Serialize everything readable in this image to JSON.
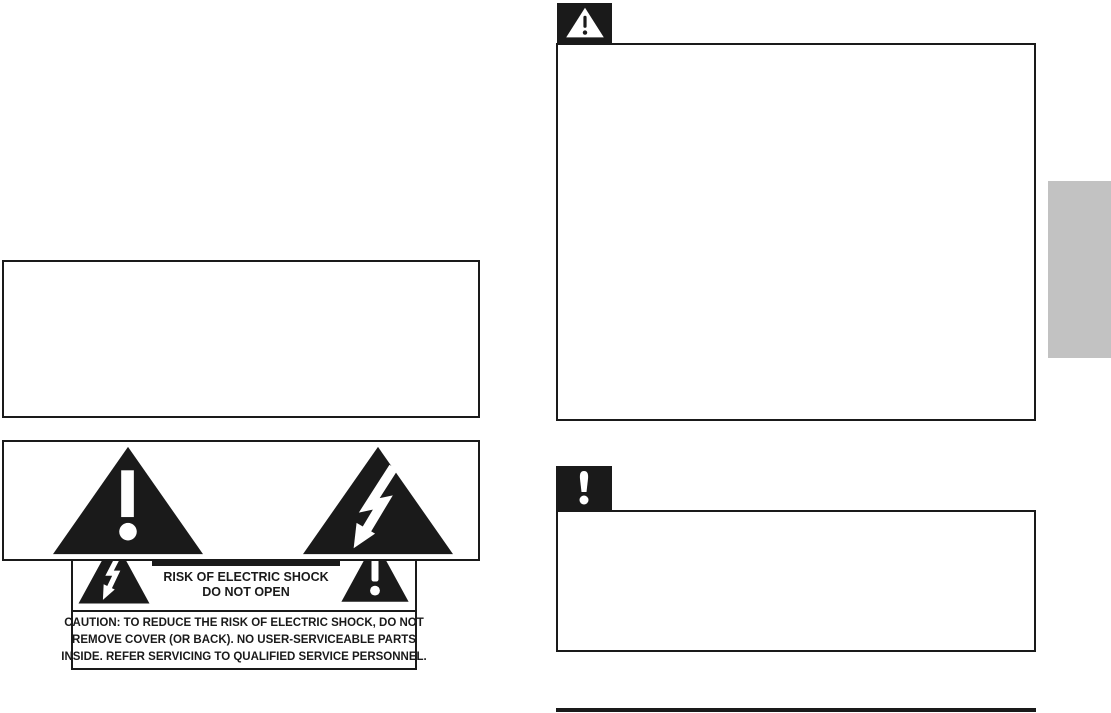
{
  "colors": {
    "ink": "#1a1a1a",
    "paper": "#ffffff",
    "side_tab_gray": "#c2c2c2"
  },
  "caution_label": {
    "banner": "CAUTION",
    "risk_line_1": "RISK OF ELECTRIC SHOCK",
    "risk_line_2": "DO NOT OPEN",
    "notice_lines": [
      "CAUTION: TO REDUCE THE RISK OF ELECTRIC SHOCK, DO NOT",
      "REMOVE COVER (OR BACK). NO USER-SERVICEABLE PARTS",
      "INSIDE. REFER SERVICING TO QUALIFIED SERVICE PERSONNEL."
    ]
  },
  "icons": {
    "lightning_triangle": "lightning-bolt-in-triangle",
    "exclamation_triangle": "exclamation-mark-in-triangle",
    "warning_note": "white-warning-triangle-on-black-square",
    "caution_note": "white-exclamation-on-black-square"
  },
  "note_boxes": {
    "warning_box_content": "",
    "caution_box_content": ""
  }
}
